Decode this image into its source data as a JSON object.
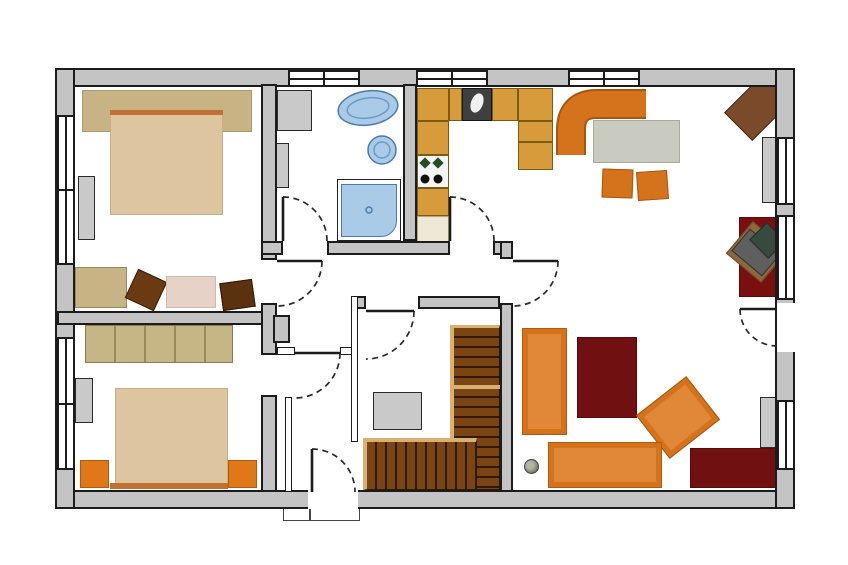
{
  "title": "apartment-floor-plan",
  "canvas": {
    "width": 848,
    "height": 565,
    "background": "#ffffff"
  },
  "palette": {
    "wall_gray": "#c4c4c4",
    "outline": "#1c1c1c",
    "counter_tan": "#d79b3c",
    "seat_orange": "#d4731c",
    "accent_orange": "#e07818",
    "rug_dark_red": "#701010",
    "bed_beige": "#ddc69f",
    "khaki": "#c7b383",
    "fixture_blue": "#aacbe8",
    "stair_brown": "#7a4513",
    "stair_edge_tan": "#d8b070",
    "furniture_gray": "#c9c9c9",
    "table_gray": "#c9cbc0",
    "wood_brown": "#7b4a2b"
  },
  "rooms": [
    {
      "name": "room-bedroom-1",
      "x": 75,
      "y": 88,
      "w": 186,
      "h": 223
    },
    {
      "name": "room-bedroom-2",
      "x": 75,
      "y": 325,
      "w": 186,
      "h": 165
    },
    {
      "name": "room-bathroom",
      "x": 277,
      "y": 88,
      "w": 126,
      "h": 153
    },
    {
      "name": "room-kitchen",
      "x": 417,
      "y": 88,
      "w": 83,
      "h": 153
    },
    {
      "name": "room-hallway",
      "x": 277,
      "y": 255,
      "w": 223,
      "h": 92
    },
    {
      "name": "room-entry-vestibule",
      "x": 292,
      "y": 355,
      "w": 58,
      "h": 135
    },
    {
      "name": "room-stair-closet",
      "x": 358,
      "y": 309,
      "w": 142,
      "h": 181
    },
    {
      "name": "room-living-dining",
      "x": 513,
      "y": 88,
      "w": 264,
      "h": 404
    }
  ],
  "walls": [
    {
      "name": "wall-outer-top",
      "x": 55,
      "y": 68,
      "w": 740,
      "h": 19
    },
    {
      "name": "wall-outer-bottom",
      "x": 55,
      "y": 490,
      "w": 740,
      "h": 19
    },
    {
      "name": "wall-outer-left",
      "x": 55,
      "y": 68,
      "w": 20,
      "h": 441
    },
    {
      "name": "wall-outer-right",
      "x": 775,
      "y": 68,
      "w": 20,
      "h": 441
    },
    {
      "name": "wall-bedrooms-divider",
      "x": 57,
      "y": 311,
      "w": 206,
      "h": 14
    },
    {
      "name": "wall-bedroom1-east-upper",
      "x": 261,
      "y": 84,
      "w": 16,
      "h": 176
    },
    {
      "name": "wall-bedroom1-east-lower",
      "x": 261,
      "y": 303,
      "w": 16,
      "h": 52
    },
    {
      "name": "wall-bedroom2-east",
      "x": 261,
      "y": 395,
      "w": 16,
      "h": 97
    },
    {
      "name": "wall-bath-south-a",
      "x": 261,
      "y": 241,
      "w": 22,
      "h": 14
    },
    {
      "name": "wall-bath-south-b",
      "x": 327,
      "y": 241,
      "w": 123,
      "h": 14
    },
    {
      "name": "wall-kitchen-south-c",
      "x": 493,
      "y": 241,
      "w": 20,
      "h": 14
    },
    {
      "name": "wall-bath-kitchen-divider",
      "x": 403,
      "y": 84,
      "w": 14,
      "h": 157
    },
    {
      "name": "wall-living-west-upper",
      "x": 500,
      "y": 241,
      "w": 13,
      "h": 18
    },
    {
      "name": "wall-living-west-lower",
      "x": 500,
      "y": 303,
      "w": 13,
      "h": 189
    },
    {
      "name": "wall-closet-north-a",
      "x": 352,
      "y": 296,
      "w": 14,
      "h": 13
    },
    {
      "name": "wall-closet-north-b",
      "x": 418,
      "y": 296,
      "w": 82,
      "h": 13
    },
    {
      "name": "wall-closet-west",
      "x": 351,
      "y": 296,
      "w": 7,
      "h": 146,
      "thin": true
    },
    {
      "name": "wall-vestibule-west",
      "x": 285,
      "y": 397,
      "w": 7,
      "h": 95,
      "thin": true
    },
    {
      "name": "wall-vestibule-north-a",
      "x": 277,
      "y": 347,
      "w": 18,
      "h": 8,
      "thin": true
    },
    {
      "name": "wall-vestibule-north-b",
      "x": 340,
      "y": 347,
      "w": 12,
      "h": 8,
      "thin": true
    },
    {
      "name": "wall-chimney-block",
      "x": 273,
      "y": 315,
      "w": 17,
      "h": 28
    }
  ],
  "windows": [
    {
      "name": "window-top-bathroom",
      "x": 288,
      "y": 70,
      "w": 72,
      "h": 17,
      "orient": "h",
      "divider": true
    },
    {
      "name": "window-top-kitchen",
      "x": 416,
      "y": 70,
      "w": 72,
      "h": 17,
      "orient": "h",
      "divider": true
    },
    {
      "name": "window-top-dining",
      "x": 568,
      "y": 70,
      "w": 72,
      "h": 17,
      "orient": "h",
      "divider": true
    },
    {
      "name": "window-left-bedroom1",
      "x": 57,
      "y": 115,
      "w": 18,
      "h": 150,
      "orient": "v",
      "divider": true
    },
    {
      "name": "window-left-bedroom2",
      "x": 57,
      "y": 337,
      "w": 18,
      "h": 133,
      "orient": "v",
      "divider": true
    },
    {
      "name": "window-right-upper",
      "x": 777,
      "y": 137,
      "w": 18,
      "h": 68,
      "orient": "v",
      "divider": false
    },
    {
      "name": "window-right-middle",
      "x": 777,
      "y": 215,
      "w": 18,
      "h": 85,
      "orient": "v",
      "divider": false
    },
    {
      "name": "window-right-lower",
      "x": 777,
      "y": 400,
      "w": 18,
      "h": 70,
      "orient": "v",
      "divider": false
    }
  ],
  "openings": [
    {
      "name": "opening-terrace-door",
      "x": 777,
      "y": 303,
      "w": 18,
      "h": 49
    },
    {
      "name": "opening-front-door",
      "x": 308,
      "y": 490,
      "w": 50,
      "h": 19
    }
  ],
  "furniture": [
    {
      "name": "bedroom1-headwall-panel",
      "x": 82,
      "y": 90,
      "w": 170,
      "h": 42,
      "bg": "#c7b383",
      "bd": "#ab9a6c"
    },
    {
      "name": "bedroom1-double-bed",
      "x": 110,
      "y": 110,
      "w": 113,
      "h": 105,
      "bg": "#ddc69f",
      "bd": "#c8ae82"
    },
    {
      "name": "bedroom1-headboard",
      "x": 110,
      "y": 110,
      "w": 113,
      "h": 5,
      "bg": "#c07030"
    },
    {
      "name": "bedroom1-dresser",
      "x": 78,
      "y": 176,
      "w": 17,
      "h": 64,
      "bg": "#c9c9c9",
      "bd": "#2a2a2a"
    },
    {
      "name": "bedroom1-rug-khaki",
      "x": 75,
      "y": 267,
      "w": 52,
      "h": 41,
      "bg": "#c7b383",
      "bd": "#9a8a5a"
    },
    {
      "name": "bedroom1-ottoman",
      "x": 130,
      "y": 274,
      "w": 32,
      "h": 32,
      "rot": 25,
      "bg": "#6b3a12",
      "bd": "#3a1d05"
    },
    {
      "name": "bedroom1-rug-pink",
      "x": 166,
      "y": 276,
      "w": 50,
      "h": 32,
      "bg": "#e7d2c8",
      "bd": "#d0b8ac"
    },
    {
      "name": "bedroom1-stool",
      "x": 221,
      "y": 281,
      "w": 33,
      "h": 28,
      "rot": -8,
      "bg": "#5a3210",
      "bd": "#2e1803"
    },
    {
      "name": "bedroom2-wardrobe",
      "x": 85,
      "y": 325,
      "w": 148,
      "h": 38,
      "bg": "#c6b686",
      "bd": "#8a7a50",
      "style": "background-image:repeating-linear-gradient(90deg, rgba(0,0,0,0) 0 28px, #9a8a5e 28px 30px)"
    },
    {
      "name": "bedroom2-double-bed",
      "x": 115,
      "y": 388,
      "w": 113,
      "h": 100,
      "bg": "#ddc69f",
      "bd": "#c8ae82"
    },
    {
      "name": "bedroom2-footboard",
      "x": 110,
      "y": 483,
      "w": 118,
      "h": 6,
      "bg": "#c07030"
    },
    {
      "name": "bedroom2-nightstand-left",
      "x": 80,
      "y": 460,
      "w": 29,
      "h": 28,
      "bg": "#e07818",
      "bd": "#b05c10"
    },
    {
      "name": "bedroom2-nightstand-right",
      "x": 228,
      "y": 460,
      "w": 29,
      "h": 28,
      "bg": "#e07818",
      "bd": "#b05c10"
    },
    {
      "name": "bedroom2-dresser",
      "x": 75,
      "y": 378,
      "w": 18,
      "h": 45,
      "bg": "#c9c9c9",
      "bd": "#2a2a2a"
    },
    {
      "name": "bathroom-washing-machine",
      "x": 277,
      "y": 90,
      "w": 35,
      "h": 41,
      "bg": "#c9c9c9",
      "bd": "#2a2a2a"
    },
    {
      "name": "bathroom-cabinet",
      "x": 273,
      "y": 143,
      "w": 16,
      "h": 45,
      "bg": "#c9c9c9",
      "bd": "#2a2a2a"
    },
    {
      "name": "shower-frame",
      "x": 337,
      "y": 179,
      "w": 64,
      "h": 62,
      "bg": "#ffffff",
      "bd": "#222222"
    },
    {
      "name": "shower-tray",
      "x": 341,
      "y": 184,
      "w": 56,
      "h": 53,
      "bg": "#aacbe8",
      "bd": "#4a7ab0",
      "radius": "0 0 16px 0"
    },
    {
      "name": "kitchen-counter-corner",
      "x": 417,
      "y": 88,
      "w": 32,
      "h": 33,
      "bg": "#d79b3c",
      "bd": "#7a5c10"
    },
    {
      "name": "kitchen-counter-top-a",
      "x": 449,
      "y": 88,
      "w": 13,
      "h": 33,
      "bg": "#d79b3c",
      "bd": "#7a5c10"
    },
    {
      "name": "kitchen-sink-unit",
      "x": 462,
      "y": 88,
      "w": 30,
      "h": 33,
      "bg": "#3f3f3f",
      "bd": "#161616"
    },
    {
      "name": "kitchen-counter-top-b",
      "x": 492,
      "y": 88,
      "w": 26,
      "h": 33,
      "bg": "#d79b3c",
      "bd": "#7a5c10"
    },
    {
      "name": "kitchen-counter-top-c",
      "x": 518,
      "y": 88,
      "w": 35,
      "h": 33,
      "bg": "#d79b3c",
      "bd": "#7a5c10"
    },
    {
      "name": "kitchen-counter-right-a",
      "x": 518,
      "y": 121,
      "w": 35,
      "h": 21,
      "bg": "#d79b3c",
      "bd": "#7a5c10"
    },
    {
      "name": "kitchen-counter-right-b",
      "x": 518,
      "y": 142,
      "w": 35,
      "h": 28,
      "bg": "#d79b3c",
      "bd": "#7a5c10"
    },
    {
      "name": "kitchen-counter-left-a",
      "x": 417,
      "y": 121,
      "w": 32,
      "h": 34,
      "bg": "#d79b3c",
      "bd": "#7a5c10"
    },
    {
      "name": "kitchen-stove",
      "x": 417,
      "y": 155,
      "w": 32,
      "h": 33,
      "bg": "#f4f4f4",
      "bd": "#7a5c10"
    },
    {
      "name": "kitchen-counter-left-b",
      "x": 417,
      "y": 188,
      "w": 32,
      "h": 28,
      "bg": "#d79b3c",
      "bd": "#7a5c10"
    },
    {
      "name": "kitchen-counter-cream",
      "x": 417,
      "y": 216,
      "w": 32,
      "h": 27,
      "bg": "#efe8d4",
      "bd": "#b0a880"
    },
    {
      "name": "dining-table",
      "x": 593,
      "y": 120,
      "w": 87,
      "h": 43,
      "bg": "#c9cbc0",
      "bd": "#a8aa9e"
    },
    {
      "name": "dining-chair-1",
      "x": 602,
      "y": 169,
      "w": 31,
      "h": 29,
      "rot": 2,
      "bg": "#d4731c",
      "bd": "#a85510"
    },
    {
      "name": "dining-chair-2",
      "x": 637,
      "y": 171,
      "w": 31,
      "h": 29,
      "rot": -4,
      "bg": "#d4731c",
      "bd": "#a85510"
    },
    {
      "name": "corner-side-table",
      "x": 730,
      "y": 87,
      "w": 56,
      "h": 40,
      "rot": -45,
      "bg": "#7b4a2b",
      "bd": "#46260e"
    },
    {
      "name": "wall-shelf-upper-right",
      "x": 762,
      "y": 137,
      "w": 18,
      "h": 66,
      "bg": "#c9c9c9",
      "bd": "#2a2a2a"
    },
    {
      "name": "desk-rug",
      "x": 739,
      "y": 217,
      "w": 40,
      "h": 80,
      "bg": "#7a0f0f",
      "bd": "#5a0a0a"
    },
    {
      "name": "desk-mat",
      "x": 734,
      "y": 231,
      "w": 46,
      "h": 42,
      "rot": 40,
      "bg": "#8a6a3c",
      "bd": "#6a4e28"
    },
    {
      "name": "desk",
      "x": 736,
      "y": 238,
      "w": 40,
      "h": 29,
      "rot": 40,
      "bg": "#5f5f5f",
      "bd": "#333333"
    },
    {
      "name": "desk-chair",
      "x": 754,
      "y": 228,
      "w": 27,
      "h": 25,
      "rot": 45,
      "bg": "#364a40",
      "bd": "#1f2e27"
    },
    {
      "name": "sofa-vertical",
      "x": 522,
      "y": 328,
      "w": 45,
      "h": 107,
      "bg": "#d4731c",
      "bd": "#b05c10",
      "inner": "#e08838"
    },
    {
      "name": "living-rug",
      "x": 577,
      "y": 337,
      "w": 60,
      "h": 81,
      "bg": "#701010",
      "bd": "#560b0b"
    },
    {
      "name": "armchair",
      "x": 646,
      "y": 390,
      "w": 64,
      "h": 55,
      "rot": -38,
      "bg": "#d4731c",
      "bd": "#a85510",
      "inner": "#e08838"
    },
    {
      "name": "sofa-horizontal",
      "x": 548,
      "y": 442,
      "w": 114,
      "h": 46,
      "bg": "#d4731c",
      "bd": "#b05c10",
      "inner": "#e08838"
    },
    {
      "name": "sideboard-rug",
      "x": 690,
      "y": 448,
      "w": 92,
      "h": 40,
      "bg": "#701010",
      "bd": "#560b0b"
    },
    {
      "name": "plant-pot",
      "x": 524,
      "y": 459,
      "w": 15,
      "h": 15,
      "radius": "50%",
      "bd": "#44443a",
      "style": "background:radial-gradient(circle at 40% 40%, #b5b5a5 0 30%, #8a8a7a 60%, #55554a)"
    },
    {
      "name": "wall-cabinet-lower-right",
      "x": 760,
      "y": 397,
      "w": 18,
      "h": 51,
      "bg": "#c9c9c9",
      "bd": "#2a2a2a"
    },
    {
      "name": "closet-chest",
      "x": 373,
      "y": 392,
      "w": 49,
      "h": 38,
      "bg": "#c9c9c9",
      "bd": "#2a2a2a"
    },
    {
      "name": "stairs-upper-flight",
      "x": 450,
      "y": 325,
      "w": 50,
      "h": 165,
      "bd": "#2e1803",
      "style": "background:repeating-linear-gradient(180deg, #7a4513 0 8px, #301a05 8px 10px);border-left:4px solid #d8b070;border-top:3px solid #d8b070"
    },
    {
      "name": "stairs-lower-flight",
      "x": 363,
      "y": 438,
      "w": 114,
      "h": 52,
      "bd": "#2e1803",
      "style": "background:repeating-linear-gradient(90deg, #7a4513 0 8px, #301a05 8px 10px);border-top:4px solid #d8b070;border-left:4px solid #d8b070"
    },
    {
      "name": "stairs-landing-divider",
      "x": 450,
      "y": 385,
      "w": 50,
      "h": 4,
      "bg": "#d8b070"
    },
    {
      "name": "front-door-threshold",
      "x": 283,
      "y": 508,
      "w": 77,
      "h": 13,
      "bg": "#ffffff",
      "bd": "#444444"
    },
    {
      "name": "front-door-threshold-divider",
      "x": 309,
      "y": 508,
      "w": 2,
      "h": 13,
      "bg": "#444444"
    }
  ],
  "doors": [
    {
      "name": "door-bathroom",
      "leaf": "M283,241 L283,197",
      "arc": "M283,197 A44,44 0 0 1 327,241"
    },
    {
      "name": "door-kitchen",
      "leaf": "M450,241 L450,197",
      "arc": "M450,197 A44,44 0 0 1 494,241"
    },
    {
      "name": "door-bedroom-1",
      "leaf": "M277,261 L322,261",
      "arc": "M322,261 A45,45 0 0 1 277,306"
    },
    {
      "name": "door-living-room",
      "leaf": "M513,261 L558,261",
      "arc": "M558,261 A45,45 0 0 1 513,306"
    },
    {
      "name": "door-stair-closet",
      "leaf": "M366,311 L414,311",
      "arc": "M414,311 A48,48 0 0 1 366,359"
    },
    {
      "name": "door-vestibule",
      "leaf": "M295,353 L340,353",
      "arc": "M340,353 A45,45 0 0 1 295,398"
    },
    {
      "name": "door-front-entry",
      "leaf": "M312,492 L312,449",
      "arc": "M312,449 A43,43 0 0 1 355,492"
    },
    {
      "name": "door-terrace",
      "leaf": "M777,309 L740,309",
      "arc": "M740,309 A37,37 0 0 0 777,346"
    }
  ],
  "svg_shapes": [
    {
      "name": "dining-corner-bench-outline",
      "tag": "path",
      "attrs": {
        "d": "M 571 155 L 571 130 Q 571 104 597 104 L 646 104",
        "stroke": "#a85510",
        "stroke-width": 30,
        "fill": "none",
        "stroke-linejoin": "round"
      }
    },
    {
      "name": "dining-corner-bench",
      "tag": "path",
      "attrs": {
        "d": "M 571 155 L 571 130 Q 571 104 597 104 L 646 104",
        "stroke": "#d4731c",
        "stroke-width": 26,
        "fill": "none",
        "stroke-linejoin": "round"
      }
    },
    {
      "name": "bathtub",
      "tag": "ellipse",
      "attrs": {
        "cx": 368,
        "cy": 108,
        "rx": 30,
        "ry": 17,
        "transform": "rotate(-8 368 108)",
        "fill": "#aacbe8",
        "stroke": "#4a7ab0",
        "stroke-width": 1.5
      }
    },
    {
      "name": "bathtub-inner-rim",
      "tag": "ellipse",
      "attrs": {
        "cx": 368,
        "cy": 108,
        "rx": 21,
        "ry": 10,
        "transform": "rotate(-8 368 108)",
        "fill": "none",
        "stroke": "#6a9ac8",
        "stroke-width": 1.5
      }
    },
    {
      "name": "washbasin",
      "tag": "circle",
      "attrs": {
        "cx": 382,
        "cy": 150,
        "r": 14,
        "fill": "#aacbe8",
        "stroke": "#4a7ab0",
        "stroke-width": 1.5
      }
    },
    {
      "name": "washbasin-inner",
      "tag": "circle",
      "attrs": {
        "cx": 382,
        "cy": 150,
        "r": 8,
        "fill": "none",
        "stroke": "#6a9ac8",
        "stroke-width": 1.5
      }
    },
    {
      "name": "kitchen-sink-basin",
      "tag": "ellipse",
      "attrs": {
        "cx": 477,
        "cy": 103,
        "rx": 6,
        "ry": 10,
        "transform": "rotate(20 477 103)",
        "fill": "#f0f0f0"
      }
    },
    {
      "name": "stove-burner-1",
      "tag": "rect",
      "attrs": {
        "x": 421,
        "y": 159,
        "width": 8,
        "height": 8,
        "transform": "rotate(45 425 163)",
        "fill": "#234d23"
      }
    },
    {
      "name": "stove-burner-2",
      "tag": "rect",
      "attrs": {
        "x": 434,
        "y": 159,
        "width": 8,
        "height": 8,
        "transform": "rotate(45 438 163)",
        "fill": "#234d23"
      }
    },
    {
      "name": "stove-burner-3",
      "tag": "circle",
      "attrs": {
        "cx": 425,
        "cy": 179,
        "r": 4.5,
        "fill": "#111111"
      }
    },
    {
      "name": "stove-burner-4",
      "tag": "circle",
      "attrs": {
        "cx": 438,
        "cy": 179,
        "r": 4.5,
        "fill": "#111111"
      }
    },
    {
      "name": "shower-drain",
      "tag": "circle",
      "attrs": {
        "cx": 369,
        "cy": 210,
        "r": 3,
        "fill": "none",
        "stroke": "#4a7ab0",
        "stroke-width": 1.5
      }
    }
  ]
}
